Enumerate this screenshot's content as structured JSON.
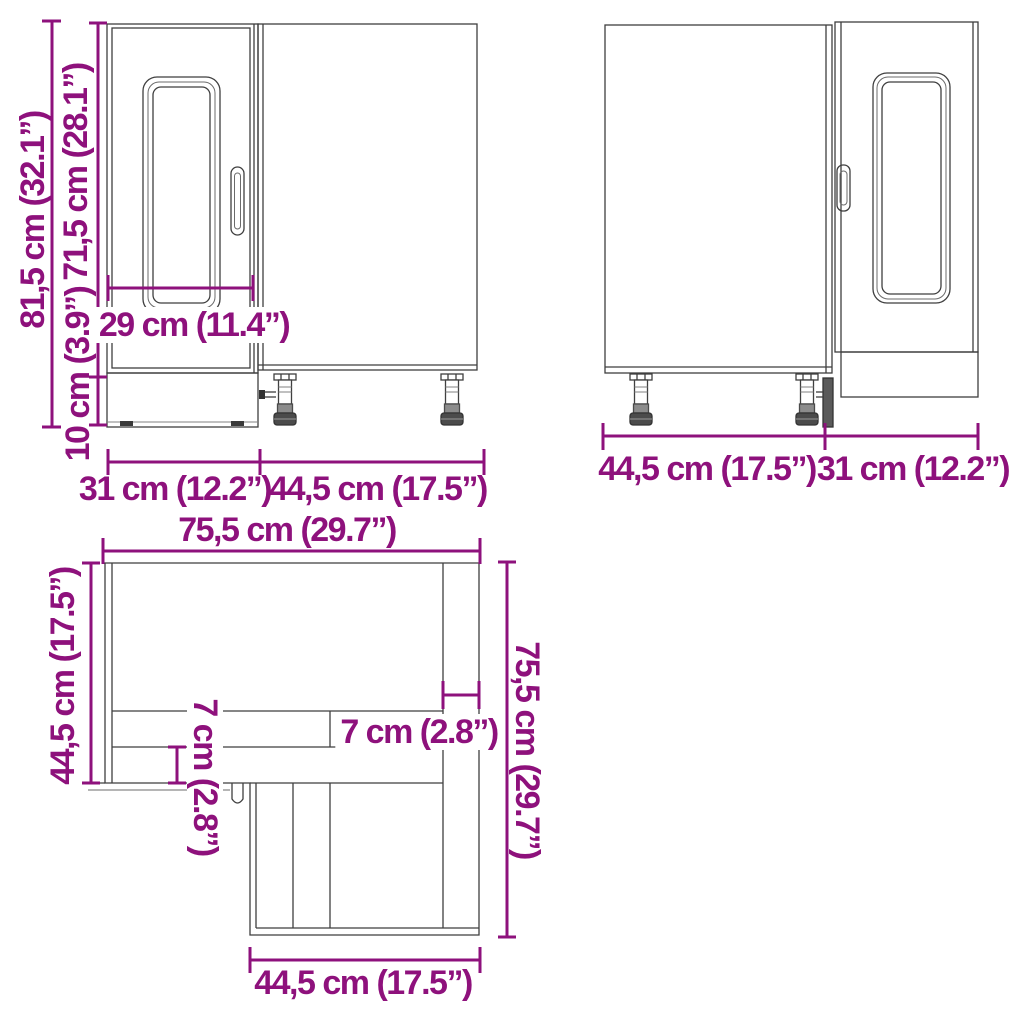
{
  "colors": {
    "dimension_accent": "#8e117c",
    "drawing_line": "#3f3f3f"
  },
  "views": {
    "front": {
      "dims": {
        "total_height": "81,5 cm (32.1”)",
        "carcass_height": "71,5 cm (28.1”)",
        "plinth_height": "10 cm (3.9”)",
        "door_width": "29 cm (11.4”)",
        "bottom_left_width": "31 cm (12.2”)",
        "bottom_right_width": "44,5 cm (17.5”)"
      }
    },
    "back": {
      "dims": {
        "bottom_left_width": "44,5 cm (17.5”)",
        "bottom_right_width": "31 cm (12.2”)"
      }
    },
    "top": {
      "dims": {
        "total_width": "75,5 cm (29.7”)",
        "left_depth": "44,5 cm (17.5”)",
        "total_depth": "75,5 cm (29.7”)",
        "front_frame_depth": "7 cm (2.8”)",
        "front_frame_width": "7 cm (2.8”)",
        "bottom_width": "44,5 cm (17.5”)"
      }
    }
  }
}
